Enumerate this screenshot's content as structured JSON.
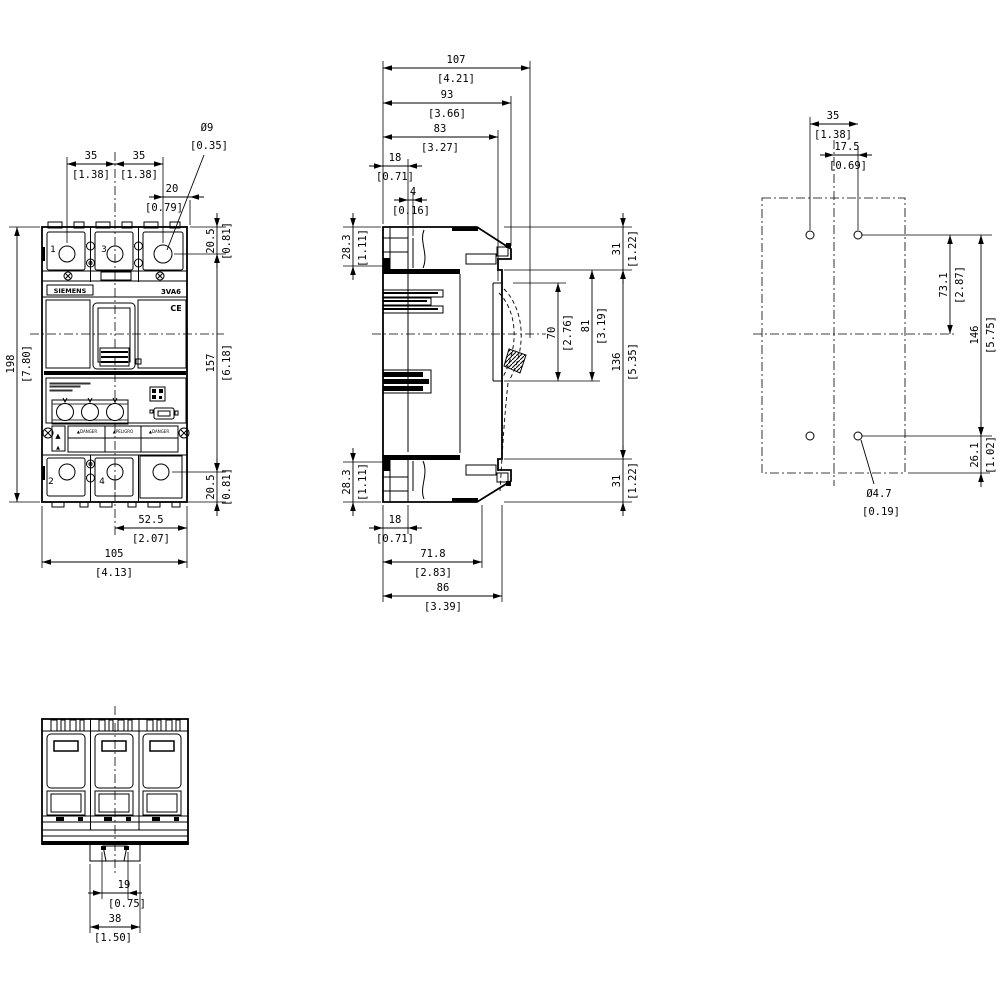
{
  "product": {
    "brand": "SIEMENS",
    "model": "3VA6",
    "ce_mark": "CE",
    "terminal_numbers_top": [
      "1",
      "3"
    ],
    "terminal_numbers_bottom": [
      "2",
      "4"
    ],
    "warning_strip": [
      "DANGER",
      "PELIGRO",
      "DANGER"
    ]
  },
  "labels": [
    {
      "name": "brand",
      "text": "SIEMENS",
      "x": 70,
      "y": 293,
      "size": 6.5,
      "bold": true,
      "anchor": "middle"
    },
    {
      "name": "model",
      "text": "3VA6",
      "x": 171,
      "y": 294,
      "size": 7,
      "bold": true,
      "anchor": "middle"
    },
    {
      "name": "ce-mark",
      "text": "CE",
      "x": 176,
      "y": 311,
      "size": 8,
      "bold": true,
      "anchor": "middle"
    },
    {
      "name": "terminal-1",
      "text": "1",
      "x": 53,
      "y": 252,
      "size": 9,
      "anchor": "middle"
    },
    {
      "name": "terminal-3",
      "text": "101",
      "x": 104,
      "y": 252,
      "size": 9,
      "anchor": "middle",
      "t": "3"
    },
    {
      "name": "terminal-2",
      "text": "2",
      "x": 51,
      "y": 484,
      "size": 9,
      "anchor": "middle"
    },
    {
      "name": "terminal-4",
      "text": "4",
      "x": 102,
      "y": 484,
      "size": 9,
      "anchor": "middle"
    },
    {
      "name": "warning-cell-1",
      "text": "▲DANGER",
      "x": 87,
      "y": 433,
      "size": 4,
      "anchor": "middle"
    },
    {
      "name": "warning-cell-2",
      "text": "▲PELIGRO",
      "x": 123,
      "y": 433,
      "size": 4,
      "anchor": "middle"
    },
    {
      "name": "warning-cell-3",
      "text": "▲DANGER",
      "x": 159,
      "y": 433,
      "size": 4,
      "anchor": "middle"
    },
    {
      "name": "warning-triangle-top",
      "text": "▲",
      "x": 58,
      "y": 438,
      "size": 7,
      "anchor": "middle"
    },
    {
      "name": "warning-triangle-bottom",
      "text": "▲",
      "x": 58,
      "y": 449,
      "size": 5,
      "anchor": "middle"
    }
  ],
  "views": {
    "front": {
      "title": "front-view",
      "dims": [
        {
          "name": "pole-pitch-left",
          "mm": "35",
          "inch": "[1.38]",
          "type": "h",
          "pos": 164,
          "from": 67,
          "to": 115,
          "arrows": "in",
          "mmAt": [
            91,
            159
          ],
          "inAt": [
            91,
            178
          ]
        },
        {
          "name": "pole-pitch-right",
          "mm": "35",
          "inch": "[1.38]",
          "type": "h",
          "pos": 164,
          "from": 115,
          "to": 163,
          "arrows": "in",
          "mmAt": [
            139,
            159
          ],
          "inAt": [
            139,
            178
          ]
        },
        {
          "name": "terminal-edge-20",
          "mm": "20",
          "inch": "[0.79]",
          "type": "h",
          "pos": 197,
          "from": 163,
          "to": 190,
          "arrows": "out",
          "mmAt": [
            172,
            192
          ],
          "inAt": [
            164,
            211
          ]
        },
        {
          "name": "terminal-hole-dia-9",
          "mm": "Ø9",
          "inch": "[0.35]",
          "type": "leader",
          "pts": [
            [
              204,
              155
            ],
            [
              167,
              250
            ]
          ],
          "mmAt": [
            207,
            131
          ],
          "inAt": [
            209,
            149
          ]
        },
        {
          "name": "top-to-terminal-20-5",
          "mm": "20.5",
          "inch": "[0.81]",
          "type": "v",
          "pos": 217,
          "from": 227,
          "to": 254,
          "arrows": "out",
          "mmAt": [
            214,
            241
          ],
          "inAt": [
            230,
            241
          ]
        },
        {
          "name": "terminal-span-157",
          "mm": "157",
          "inch": "[6.18]",
          "type": "v",
          "pos": 217,
          "from": 254,
          "to": 472,
          "arrows": "in",
          "mmAt": [
            214,
            363
          ],
          "inAt": [
            230,
            363
          ]
        },
        {
          "name": "bottom-to-terminal-20-5",
          "mm": "20.5",
          "inch": "[0.81]",
          "type": "v",
          "pos": 217,
          "from": 472,
          "to": 502,
          "arrows": "out",
          "mmAt": [
            214,
            487
          ],
          "inAt": [
            230,
            487
          ]
        },
        {
          "name": "height-198",
          "mm": "198",
          "inch": "[7.80]",
          "type": "v",
          "pos": 17,
          "from": 227,
          "to": 502,
          "arrows": "in",
          "mmAt": [
            14,
            364
          ],
          "inAt": [
            30,
            364
          ]
        },
        {
          "name": "center-to-edge-52-5",
          "mm": "52.5",
          "inch": "[2.07]",
          "type": "h",
          "pos": 528,
          "from": 115,
          "to": 187,
          "arrows": "in",
          "mmAt": [
            151,
            523
          ],
          "inAt": [
            151,
            542
          ]
        },
        {
          "name": "width-105",
          "mm": "105",
          "inch": "[4.13]",
          "type": "h",
          "pos": 562,
          "from": 42,
          "to": 187,
          "arrows": "in",
          "mmAt": [
            114,
            557
          ],
          "inAt": [
            114,
            576
          ]
        }
      ]
    },
    "side": {
      "title": "side-view",
      "dims": [
        {
          "name": "depth-107",
          "mm": "107",
          "inch": "[4.21]",
          "type": "h",
          "pos": 68,
          "from": 383,
          "to": 530,
          "arrows": "in",
          "mmAt": [
            456,
            63
          ],
          "inAt": [
            456,
            82
          ]
        },
        {
          "name": "depth-93",
          "mm": "93",
          "inch": "[3.66]",
          "type": "h",
          "pos": 103,
          "from": 383,
          "to": 511,
          "arrows": "in",
          "mmAt": [
            447,
            98
          ],
          "inAt": [
            447,
            117
          ]
        },
        {
          "name": "depth-83",
          "mm": "83",
          "inch": "[3.27]",
          "type": "h",
          "pos": 137,
          "from": 383,
          "to": 498,
          "arrows": "in",
          "mmAt": [
            440,
            132
          ],
          "inAt": [
            440,
            151
          ]
        },
        {
          "name": "rear-18-top",
          "mm": "18",
          "inch": "[0.71]",
          "type": "h",
          "pos": 166,
          "from": 383,
          "to": 408,
          "arrows": "out",
          "mmAt": [
            395,
            161
          ],
          "inAt": [
            395,
            180
          ]
        },
        {
          "name": "rear-step-4",
          "mm": "4",
          "inch": "[0.16]",
          "type": "h",
          "pos": 200,
          "from": 408,
          "to": 413,
          "arrows": "out",
          "mmAt": [
            413,
            195
          ],
          "inAt": [
            411,
            214
          ]
        },
        {
          "name": "top-28-3",
          "mm": "28.3",
          "inch": "[1.11]",
          "type": "v",
          "pos": 353,
          "from": 227,
          "to": 266,
          "arrows": "out",
          "mmAt": [
            350,
            247
          ],
          "inAt": [
            366,
            248
          ]
        },
        {
          "name": "bottom-28-3",
          "mm": "28.3",
          "inch": "[1.11]",
          "type": "v",
          "pos": 353,
          "from": 462,
          "to": 502,
          "arrows": "out",
          "mmAt": [
            350,
            482
          ],
          "inAt": [
            366,
            482
          ]
        },
        {
          "name": "top-31",
          "mm": "31",
          "inch": "[1.22]",
          "type": "v",
          "pos": 623,
          "from": 227,
          "to": 270,
          "arrows": "out",
          "mmAt": [
            620,
            249
          ],
          "inAt": [
            636,
            249
          ]
        },
        {
          "name": "handle-70",
          "mm": "70",
          "inch": "[2.76]",
          "type": "v",
          "pos": 558,
          "from": 283,
          "to": 381,
          "arrows": "in",
          "mmAt": [
            555,
            333
          ],
          "inAt": [
            571,
            333
          ]
        },
        {
          "name": "handle-81",
          "mm": "81",
          "inch": "[3.19]",
          "type": "v",
          "pos": 592,
          "from": 270,
          "to": 381,
          "arrows": "in",
          "mmAt": [
            589,
            326
          ],
          "inAt": [
            605,
            326
          ]
        },
        {
          "name": "mid-136",
          "mm": "136",
          "inch": "[5.35]",
          "type": "v",
          "pos": 623,
          "from": 270,
          "to": 459,
          "arrows": "in",
          "mmAt": [
            620,
            362
          ],
          "inAt": [
            636,
            362
          ]
        },
        {
          "name": "bottom-31",
          "mm": "31",
          "inch": "[1.22]",
          "type": "v",
          "pos": 623,
          "from": 459,
          "to": 502,
          "arrows": "out",
          "mmAt": [
            620,
            481
          ],
          "inAt": [
            636,
            481
          ]
        },
        {
          "name": "rear-18-bottom",
          "mm": "18",
          "inch": "[0.71]",
          "type": "h",
          "pos": 528,
          "from": 383,
          "to": 408,
          "arrows": "out",
          "mmAt": [
            395,
            523
          ],
          "inAt": [
            395,
            542
          ]
        },
        {
          "name": "depth-71-8",
          "mm": "71.8",
          "inch": "[2.83]",
          "type": "h",
          "pos": 562,
          "from": 383,
          "to": 482,
          "arrows": "in",
          "mmAt": [
            433,
            557
          ],
          "inAt": [
            433,
            576
          ]
        },
        {
          "name": "depth-86",
          "mm": "86",
          "inch": "[3.39]",
          "type": "h",
          "pos": 596,
          "from": 383,
          "to": 502,
          "arrows": "in",
          "mmAt": [
            443,
            591
          ],
          "inAt": [
            443,
            610
          ]
        }
      ]
    },
    "drill": {
      "title": "drilling-pattern",
      "dims": [
        {
          "name": "hole-pitch-35",
          "mm": "35",
          "inch": "[1.38]",
          "type": "h",
          "pos": 124,
          "from": 810,
          "to": 858,
          "arrows": "in",
          "mmAt": [
            833,
            119
          ],
          "inAt": [
            833,
            138
          ]
        },
        {
          "name": "half-pitch-17-5",
          "mm": "17.5",
          "inch": "[0.69]",
          "type": "h",
          "pos": 155,
          "from": 834,
          "to": 858,
          "arrows": "out",
          "mmAt": [
            847,
            150
          ],
          "inAt": [
            848,
            169
          ]
        },
        {
          "name": "hole-to-center-73-1",
          "mm": "73.1",
          "inch": "[2.87]",
          "type": "v",
          "pos": 950,
          "from": 235,
          "to": 334,
          "arrows": "in",
          "mmAt": [
            947,
            285
          ],
          "inAt": [
            963,
            285
          ]
        },
        {
          "name": "hole-span-146",
          "mm": "146",
          "inch": "[5.75]",
          "type": "v",
          "pos": 981,
          "from": 235,
          "to": 436,
          "arrows": "in",
          "mmAt": [
            978,
            335
          ],
          "inAt": [
            994,
            335
          ]
        },
        {
          "name": "hole-to-bottom-26-1",
          "mm": "26.1",
          "inch": "[1.02]",
          "type": "v",
          "pos": 981,
          "from": 436,
          "to": 473,
          "arrows": "out",
          "mmAt": [
            978,
            455
          ],
          "inAt": [
            994,
            455
          ]
        },
        {
          "name": "hole-dia-4-7",
          "mm": "Ø4.7",
          "inch": "[0.19]",
          "type": "leader",
          "pts": [
            [
              861,
              440
            ],
            [
              874,
              484
            ]
          ],
          "mmAt": [
            879,
            497
          ],
          "inAt": [
            881,
            515
          ]
        }
      ]
    },
    "bottom": {
      "title": "bottom-view",
      "dims": [
        {
          "name": "clip-slot-19",
          "mm": "19",
          "inch": "[0.75]",
          "type": "h",
          "pos": 893,
          "from": 102,
          "to": 128,
          "arrows": "out",
          "mmAt": [
            124,
            888
          ],
          "inAt": [
            127,
            907
          ]
        },
        {
          "name": "clip-width-38",
          "mm": "38",
          "inch": "[1.50]",
          "type": "h",
          "pos": 927,
          "from": 90,
          "to": 140,
          "arrows": "in",
          "mmAt": [
            115,
            922
          ],
          "inAt": [
            113,
            941
          ]
        }
      ]
    }
  }
}
